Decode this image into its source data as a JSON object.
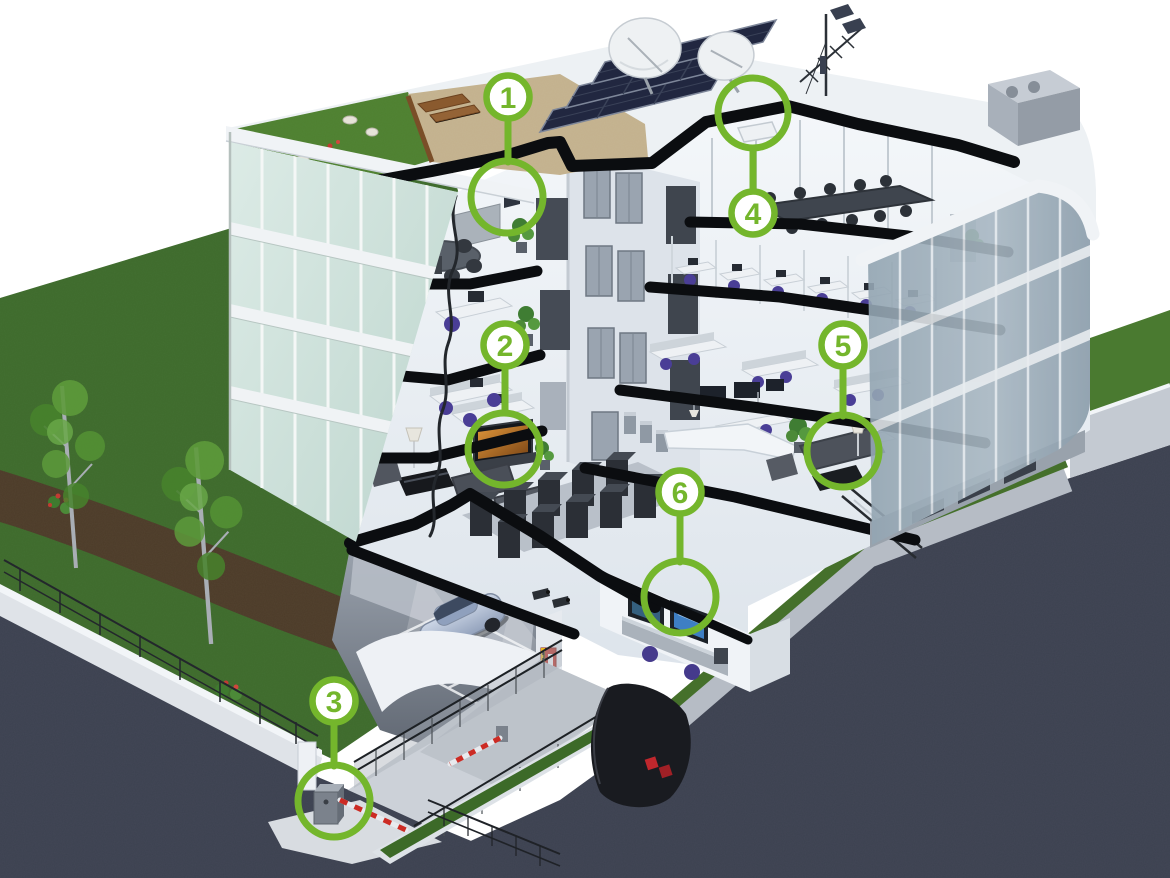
{
  "illustration": {
    "name": "smart-office-building-cutaway",
    "description": "3D cutaway illustration of a four-storey office building with green roof, rooftop solar panels, satellite dishes, underground car park and six numbered feature callouts",
    "accent_green": "#74b62c"
  },
  "markers": [
    {
      "id": "marker-1",
      "number": "1"
    },
    {
      "id": "marker-2",
      "number": "2"
    },
    {
      "id": "marker-3",
      "number": "3"
    },
    {
      "id": "marker-4",
      "number": "4"
    },
    {
      "id": "marker-5",
      "number": "5"
    },
    {
      "id": "marker-6",
      "number": "6"
    }
  ],
  "parking": {
    "space_labels": [
      "02",
      "2A",
      "24"
    ]
  }
}
